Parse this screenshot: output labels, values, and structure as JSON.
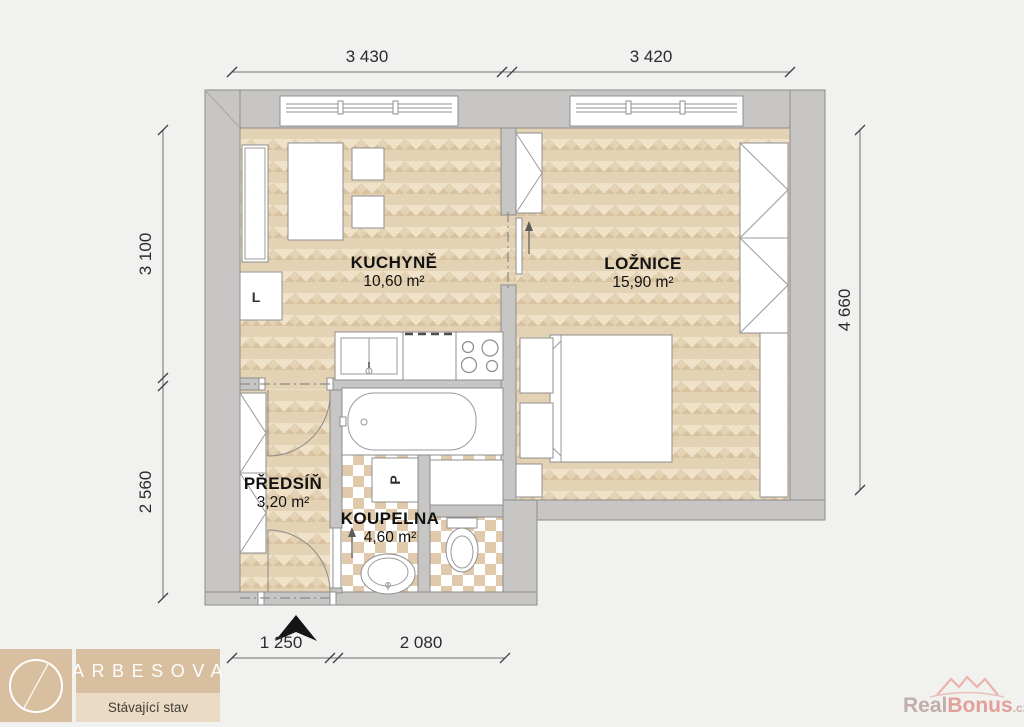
{
  "plan": {
    "rooms": [
      {
        "id": "kuchyne",
        "name": "KUCHYNĚ",
        "area": "10,60 m²"
      },
      {
        "id": "loznice",
        "name": "LOŽNICE",
        "area": "15,90 m²"
      },
      {
        "id": "predsin",
        "name": "PŘEDSÍŇ",
        "area": "3,20 m²"
      },
      {
        "id": "koupelna",
        "name": "KOUPELNA",
        "area": "4,60 m²"
      }
    ],
    "dimensions": {
      "top": [
        "3 430",
        "3 420"
      ],
      "left": [
        "3 100",
        "2 560"
      ],
      "right": [
        "4 660"
      ],
      "bottom": [
        "1 250",
        "2 080"
      ]
    },
    "fixtures": {
      "washer_label": "P",
      "fridge_label": "L"
    }
  },
  "branding": {
    "project_name": "ARBESOVA",
    "subtitle": "Stávající stav"
  },
  "watermark": {
    "part1": "Real",
    "part2": "Bonus",
    "part3": ".cz"
  },
  "colors": {
    "bg": "#f1f1f0",
    "wall": "#c7c6c4",
    "tile": "#e0caab",
    "logo_tan": "#d8bf9f",
    "logo_sub": "#ecdbc4",
    "wm_real": "#c2adaa",
    "wm_bonus": "#e2a099",
    "wm_cz": "#d3b1a9"
  }
}
